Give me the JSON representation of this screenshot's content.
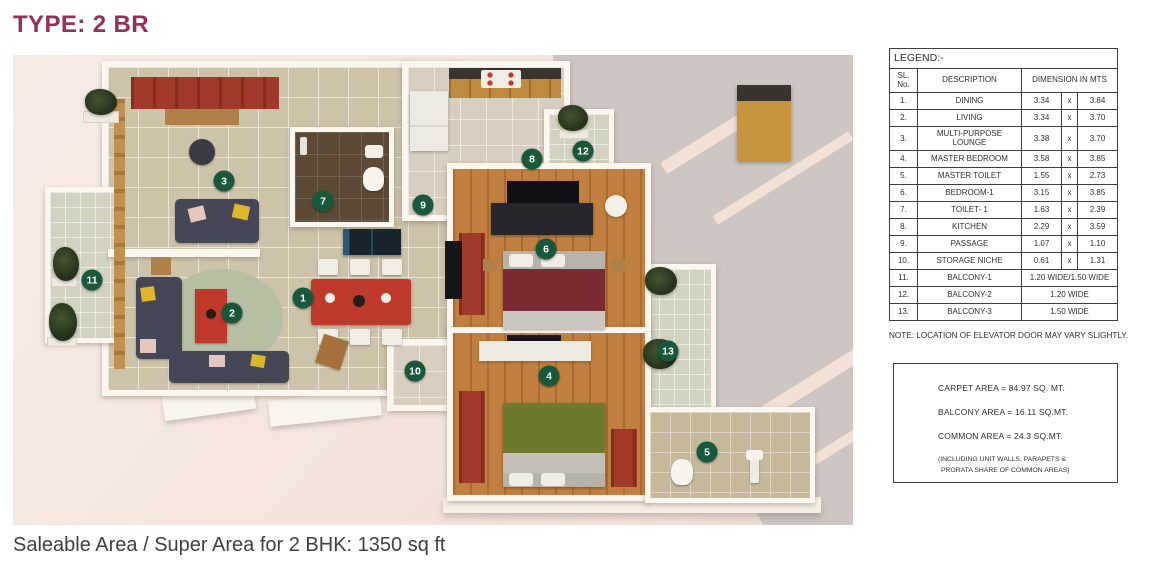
{
  "title": "TYPE: 2 BR",
  "footer": "Saleable Area / Super Area for 2 BHK: 1350 sq ft",
  "colors": {
    "title": "#962f5a",
    "marker": "#17593a",
    "plan_background": "#f3e5dc",
    "gray_surface": "#cdc6c3"
  },
  "legend": {
    "title": "LEGEND:-",
    "col_sl": "SL. No.",
    "col_desc": "DESCRIPTION",
    "col_dim": "DIMENSION IN MTS",
    "rows": [
      {
        "no": "1.",
        "desc": "DINING",
        "w": "3.34",
        "x": "x",
        "h": "3.84"
      },
      {
        "no": "2.",
        "desc": "LIVING",
        "w": "3.34",
        "x": "x",
        "h": "3.70"
      },
      {
        "no": "3.",
        "desc": "MULTI-PURPOSE LOUNGE",
        "w": "3.38",
        "x": "x",
        "h": "3.70"
      },
      {
        "no": "4.",
        "desc": "MASTER BEDROOM",
        "w": "3.58",
        "x": "x",
        "h": "3.85"
      },
      {
        "no": "5.",
        "desc": "MASTER TOILET",
        "w": "1.55",
        "x": "x",
        "h": "2.73"
      },
      {
        "no": "6.",
        "desc": "BEDROOM-1",
        "w": "3.15",
        "x": "x",
        "h": "3.85"
      },
      {
        "no": "7.",
        "desc": "TOILET- 1",
        "w": "1.63",
        "x": "x",
        "h": "2.39"
      },
      {
        "no": "8.",
        "desc": "KITCHEN",
        "w": "2.29",
        "x": "x",
        "h": "3.59"
      },
      {
        "no": "9.",
        "desc": "PASSAGE",
        "w": "1.07",
        "x": "x",
        "h": "1.10"
      },
      {
        "no": "10.",
        "desc": "STORAGE NICHE",
        "w": "0.61",
        "x": "x",
        "h": "1.31"
      },
      {
        "no": "11.",
        "desc": "BALCONY-1",
        "dim": "1.20 WIDE/1.50 WIDE"
      },
      {
        "no": "12.",
        "desc": "BALCONY-2",
        "dim": "1.20 WIDE"
      },
      {
        "no": "13.",
        "desc": "BALCONY-3",
        "dim": "1.50 WIDE"
      }
    ],
    "note": "NOTE: LOCATION OF ELEVATOR DOOR MAY VARY SLIGHTLY."
  },
  "areas": {
    "lines": [
      {
        "label": "CARPET AREA",
        "eq": "=",
        "value": "84.97 SQ. MT."
      },
      {
        "label": "BALCONY AREA",
        "eq": "=",
        "value": "16.11 SQ.MT."
      },
      {
        "label": "COMMON AREA",
        "eq": "=",
        "value": "24.3 SQ.MT."
      }
    ],
    "note_line1": "(INCLUDING UNIT WALLS, PARAPETS &",
    "note_line2": "PRORATA SHARE OF COMMON AREAS)"
  },
  "plan": {
    "markers": [
      {
        "n": "1",
        "label": "dining",
        "x": 290,
        "y": 243
      },
      {
        "n": "2",
        "label": "living",
        "x": 219,
        "y": 258
      },
      {
        "n": "3",
        "label": "multi-purpose-lounge",
        "x": 211,
        "y": 126
      },
      {
        "n": "4",
        "label": "master-bedroom",
        "x": 536,
        "y": 321
      },
      {
        "n": "5",
        "label": "master-toilet",
        "x": 694,
        "y": 397
      },
      {
        "n": "6",
        "label": "bedroom-1",
        "x": 533,
        "y": 194
      },
      {
        "n": "7",
        "label": "toilet-1",
        "x": 310,
        "y": 146
      },
      {
        "n": "8",
        "label": "kitchen",
        "x": 519,
        "y": 104
      },
      {
        "n": "9",
        "label": "passage",
        "x": 410,
        "y": 150
      },
      {
        "n": "10",
        "label": "storage-niche",
        "x": 402,
        "y": 316
      },
      {
        "n": "11",
        "label": "balcony-1",
        "x": 79,
        "y": 225
      },
      {
        "n": "12",
        "label": "balcony-2",
        "x": 570,
        "y": 96
      },
      {
        "n": "13",
        "label": "balcony-3",
        "x": 655,
        "y": 296
      }
    ]
  }
}
